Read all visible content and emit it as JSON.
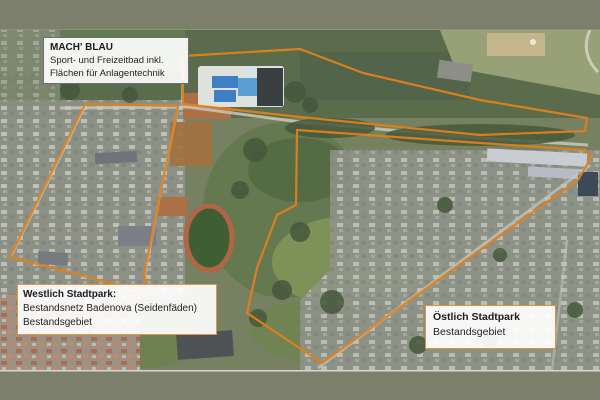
{
  "frame": {
    "bar_color": "#7b7f6c"
  },
  "map": {
    "kind": "satellite-annotation",
    "accent_color": "#e2801c",
    "boundaries": [
      {
        "name": "mach-blau-area",
        "points": "183,56 300,49 363,73 480,100 587,118 585,131 480,135 300,117 183,104"
      },
      {
        "name": "westlich-stadtpark-area",
        "points": "85,104 178,106 160,195 144,275 150,293 10,257"
      },
      {
        "name": "oestlich-stadtpark-area",
        "points": "297,130 480,143 585,150 592,156 578,180 322,363 247,313 257,268 277,215 296,205"
      }
    ],
    "labels": {
      "mach_blau": {
        "title": "MACH' BLAU",
        "lines": [
          "Sport- und Freizeitbad inkl.",
          "Flächen für Anlagentechnik"
        ]
      },
      "westlich": {
        "title": "Westlich Stadtpark:",
        "lines": [
          "Bestandsnetz Badenova (Seidenfäden)",
          "Bestandsgebiet"
        ]
      },
      "oestlich": {
        "title": "Östlich Stadtpark",
        "lines": [
          "Bestandsgebiet"
        ]
      }
    }
  }
}
